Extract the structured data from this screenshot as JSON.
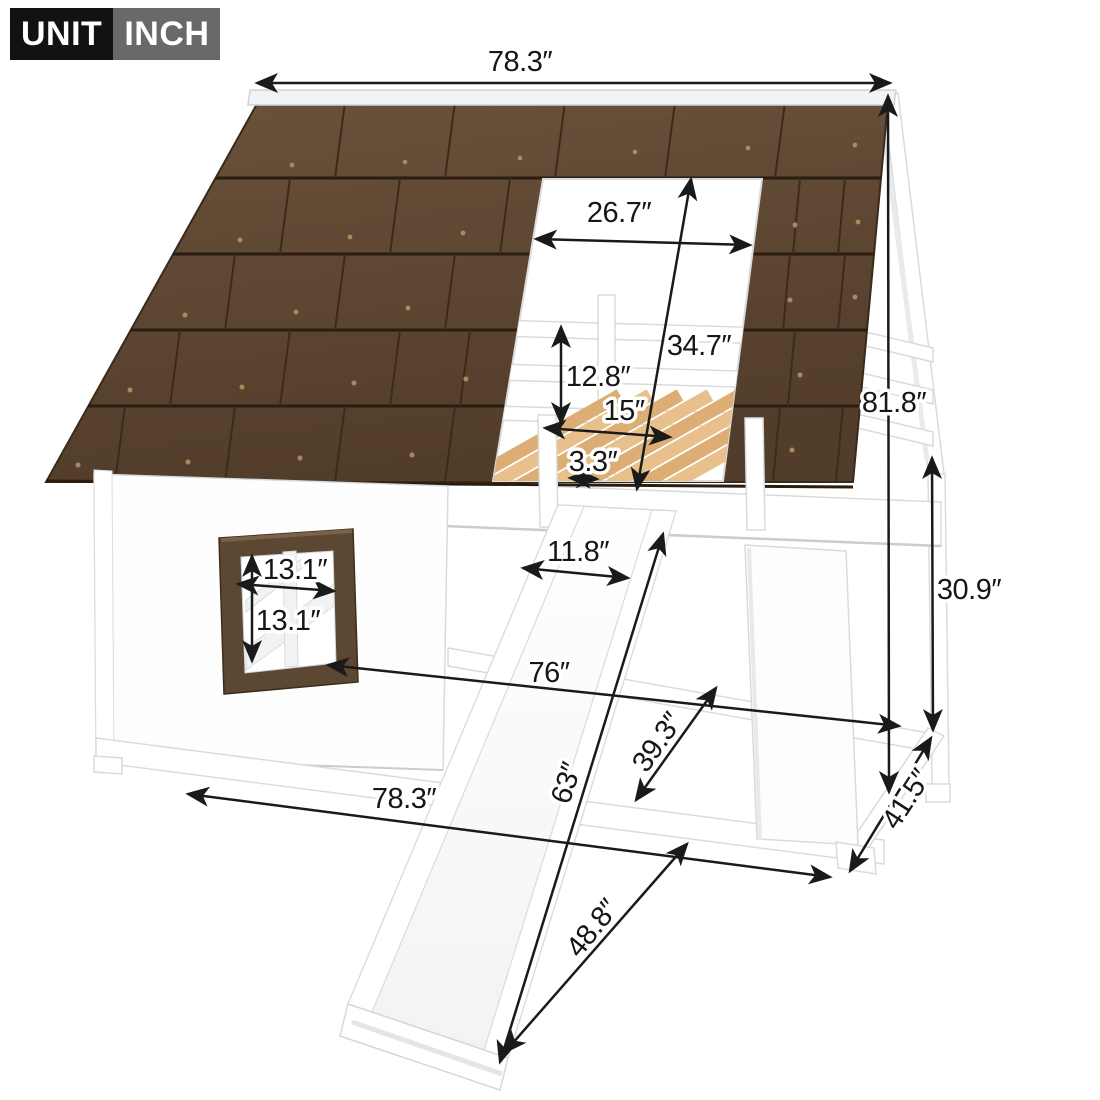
{
  "badge": {
    "label": "UNIT",
    "value": "INCH"
  },
  "dimensions": {
    "top_width": "78.3″",
    "roof_opening_width": "26.7″",
    "roof_opening_height": "34.7″",
    "guardrail_height": "12.8″",
    "slide_opening_width": "15″",
    "slat_width": "3.3″",
    "overall_height": "81.8″",
    "underbed_clearance": "30.9″",
    "window_width": "13.1″",
    "window_height": "13.1″",
    "slide_width": "11.8″",
    "bed_length": "76″",
    "bed_depth": "39.3″",
    "floor_length": "63″",
    "base_length": "78.3″",
    "slide_length": "48.8″",
    "base_depth": "41.5″"
  },
  "colors": {
    "roof_brown": "#5E4733",
    "roof_line": "#2A1C10",
    "slat_tan": "#DCAE74",
    "window_brown": "#5C4733",
    "frame_white": "#FFFFFF",
    "outline_gray": "#D8DBDD",
    "dimension_black": "#1A1A1A",
    "badge_black": "#121212",
    "badge_gray": "#67696B"
  }
}
